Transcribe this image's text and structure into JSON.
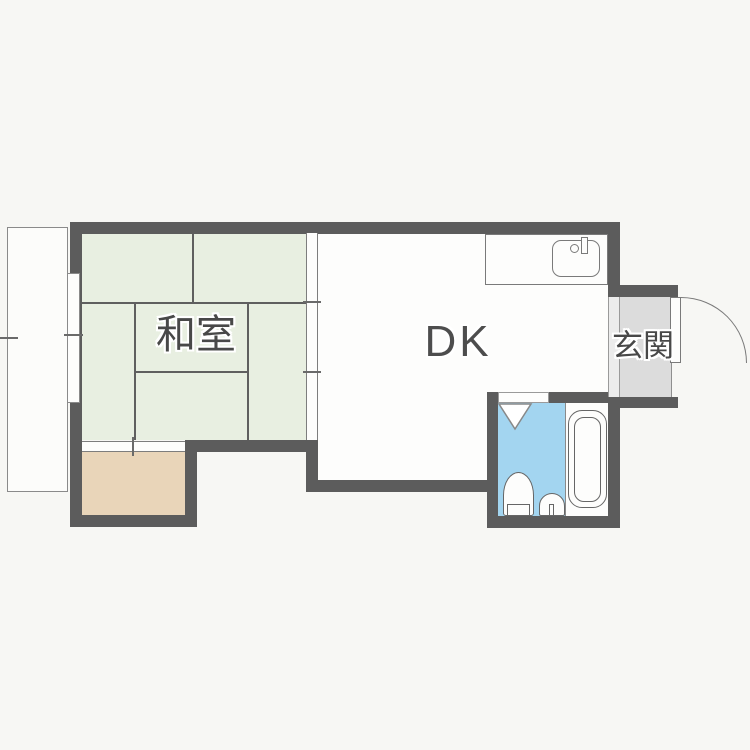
{
  "floorplan": {
    "rooms": {
      "washitsu": {
        "label": "和室"
      },
      "dining_kitchen": {
        "label": "DK"
      },
      "genkan": {
        "label": "玄関"
      }
    },
    "colors": {
      "background": "#f7f7f4",
      "wall": "#5c5c5c",
      "tatami": "#e8efe1",
      "closet": "#e9d5b9",
      "bathroom": "#a3d5f0",
      "genkan": "#dcdcdc",
      "room_floor": "#fdfdfc",
      "fixture_outline": "#666666"
    },
    "fixtures": [
      "balcony",
      "kitchen-sink",
      "bathtub",
      "toilet",
      "hand-basin",
      "entry-door-swing",
      "bathroom-door-swing",
      "sliding-door",
      "closet-door",
      "window"
    ]
  }
}
